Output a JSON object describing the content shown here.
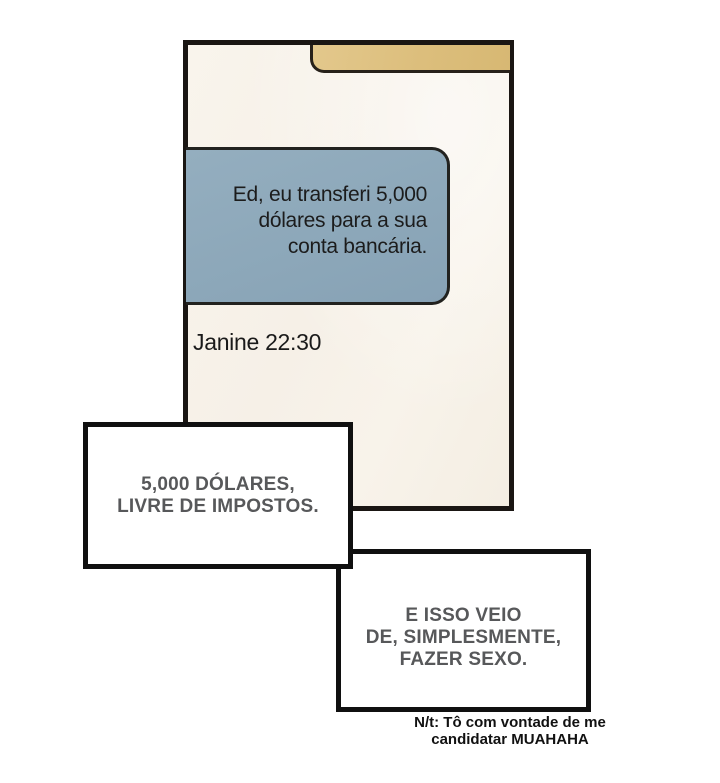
{
  "phone": {
    "message": {
      "lines": [
        "Ed, eu transferi 5,000",
        "dólares para a sua",
        "conta bancária."
      ]
    },
    "sender": "Janine 22:30"
  },
  "captions": [
    {
      "lines": [
        "5,000 DÓLARES,",
        "LIVRE DE IMPOSTOS."
      ]
    },
    {
      "lines": [
        "E ISSO VEIO",
        "DE, SIMPLESMENTE,",
        "FAZER SEXO."
      ]
    }
  ],
  "note": {
    "lines": [
      "N/t: Tô com vontade de me",
      "candidatar MUAHAHA"
    ]
  },
  "colors": {
    "page_background": "#ffffff",
    "screen_background": "#f7f1e8",
    "notification_bar": "#ddc081",
    "bubble": "#8ea9bb",
    "panel_outline": "#1a1613",
    "caption_text": "#57585a",
    "message_text": "#1c1c1c"
  }
}
